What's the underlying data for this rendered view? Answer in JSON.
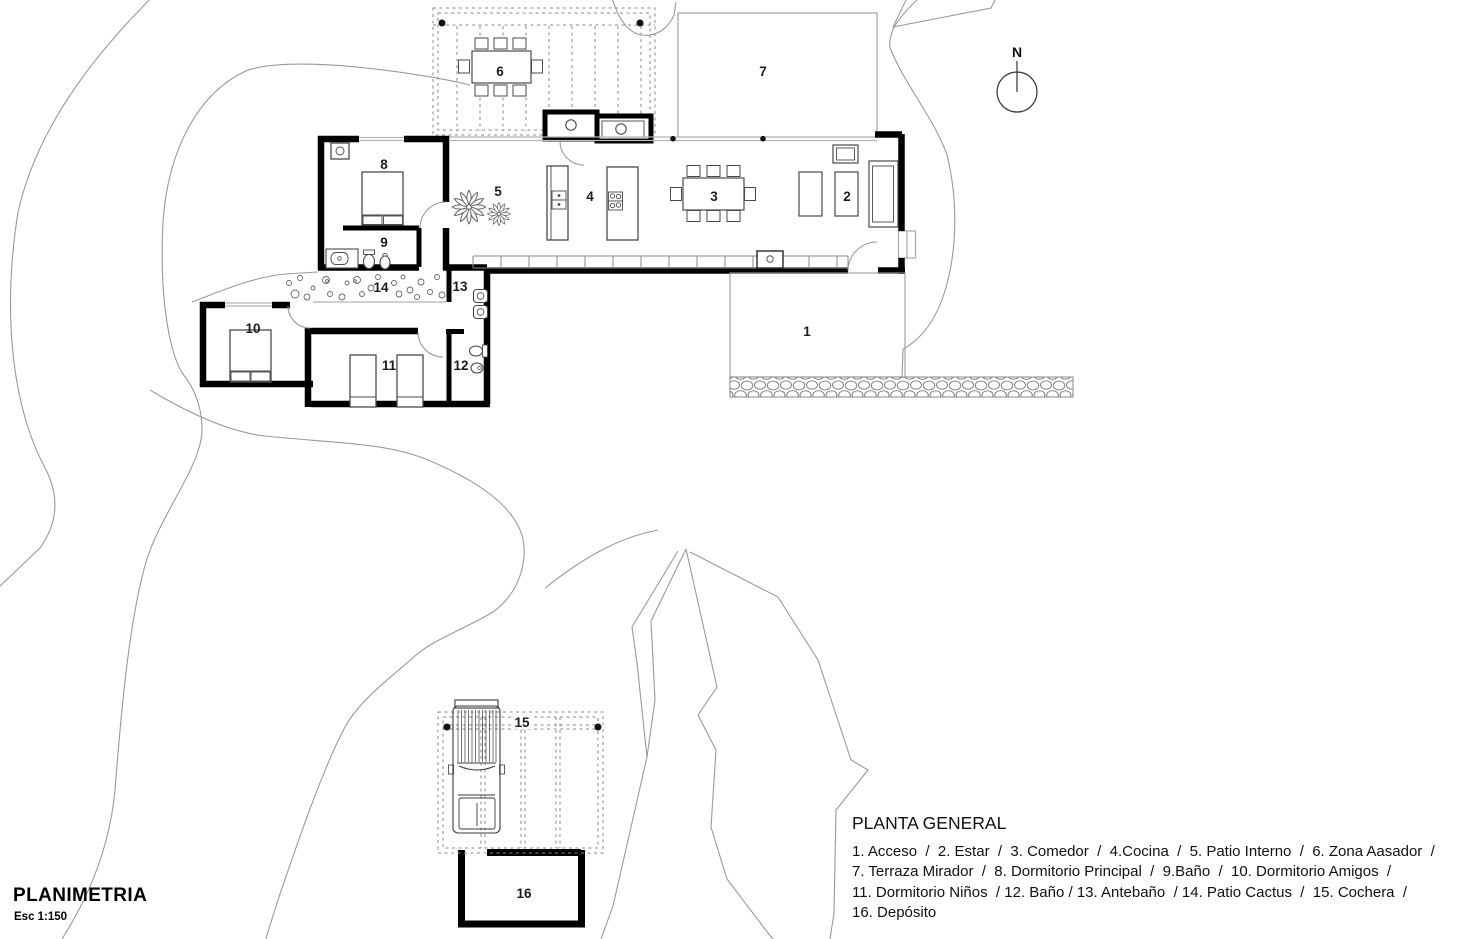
{
  "plan_title": {
    "text": "PLANIMETRIA",
    "scale": "Esc 1:150"
  },
  "north_label": "N",
  "legend": {
    "title": "PLANTA GENERAL",
    "lines": [
      "1. Acceso  /  2. Estar  /  3. Comedor  /  4.Cocina  /  5. Patio Interno  /  6. Zona Aasador  /",
      "7. Terraza Mirador  /  8. Dormitorio Principal  /  9.Baño  /  10. Dormitorio Amigos  /",
      "11. Dormitorio Niños  / 12. Baño / 13. Antebaño  / 14. Patio Cactus  /  15. Cochera  /",
      "16. Depósito"
    ]
  },
  "rooms": [
    {
      "number": "1",
      "name": "Acceso"
    },
    {
      "number": "2",
      "name": "Estar"
    },
    {
      "number": "3",
      "name": "Comedor"
    },
    {
      "number": "4",
      "name": "Cocina"
    },
    {
      "number": "5",
      "name": "Patio Interno"
    },
    {
      "number": "6",
      "name": "Zona Aasador"
    },
    {
      "number": "7",
      "name": "Terraza Mirador"
    },
    {
      "number": "8",
      "name": "Dormitorio Principal"
    },
    {
      "number": "9",
      "name": "Baño"
    },
    {
      "number": "10",
      "name": "Dormitorio Amigos"
    },
    {
      "number": "11",
      "name": "Dormitorio Niños"
    },
    {
      "number": "12",
      "name": "Baño"
    },
    {
      "number": "13",
      "name": "Antebaño"
    },
    {
      "number": "14",
      "name": "Patio Cactus"
    },
    {
      "number": "15",
      "name": "Cochera"
    },
    {
      "number": "16",
      "name": "Depósito"
    }
  ],
  "colors": {
    "walls": "#000000",
    "site_lines": "#9a9a9a",
    "furniture": "#4a4a4a",
    "glass": "#b5b5b5",
    "background": "#ffffff",
    "text": "#1a1a1a"
  }
}
